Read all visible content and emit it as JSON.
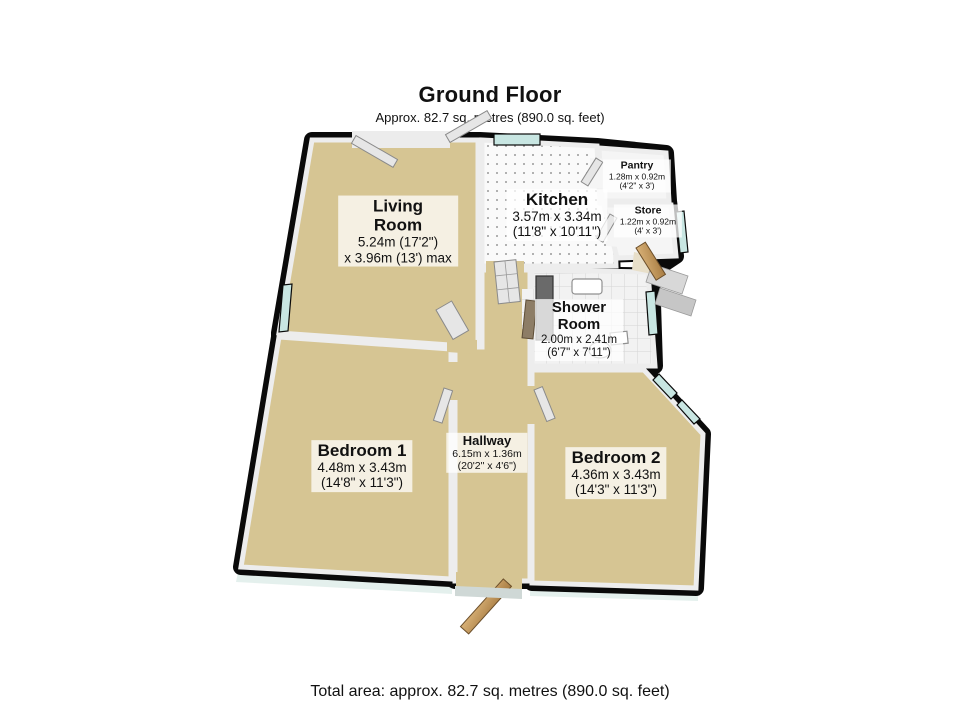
{
  "header": {
    "title": "Ground Floor",
    "subtitle": "Approx. 82.7 sq. metres (890.0 sq. feet)"
  },
  "footer": {
    "total_area": "Total area: approx. 82.7 sq. metres (890.0 sq. feet)"
  },
  "rooms": {
    "living_room": {
      "name": "Living\nRoom",
      "dimensions": "5.24m (17'2\")\nx 3.96m (13') max"
    },
    "kitchen": {
      "name": "Kitchen",
      "dimensions": "3.57m x 3.34m\n(11'8\" x 10'11\")"
    },
    "pantry": {
      "name": "Pantry",
      "dimensions": "1.28m x 0.92m\n(4'2\" x 3')"
    },
    "store": {
      "name": "Store",
      "dimensions": "1.22m x 0.92m\n(4' x 3')"
    },
    "shower_room": {
      "name": "Shower\nRoom",
      "dimensions": "2.00m x 2.41m\n(6'7\" x 7'11\")"
    },
    "bedroom_1": {
      "name": "Bedroom 1",
      "dimensions": "4.48m x 3.43m\n(14'8\" x 11'3\")"
    },
    "hallway": {
      "name": "Hallway",
      "dimensions": "6.15m x 1.36m\n(20'2\" x 4'6\")"
    },
    "bedroom_2": {
      "name": "Bedroom 2",
      "dimensions": "4.36m x 3.43m\n(14'3\" x 11'3\")"
    }
  },
  "colors": {
    "background": "#ffffff",
    "text": "#111111",
    "wall": "#0a0a0a",
    "wall_face": "#ededed",
    "carpet": "#d6c593",
    "small_room_floor": "#f5f5f5",
    "glass": "#c8e6e2",
    "wood": "#c79d63",
    "shadow": "#cde4df"
  }
}
